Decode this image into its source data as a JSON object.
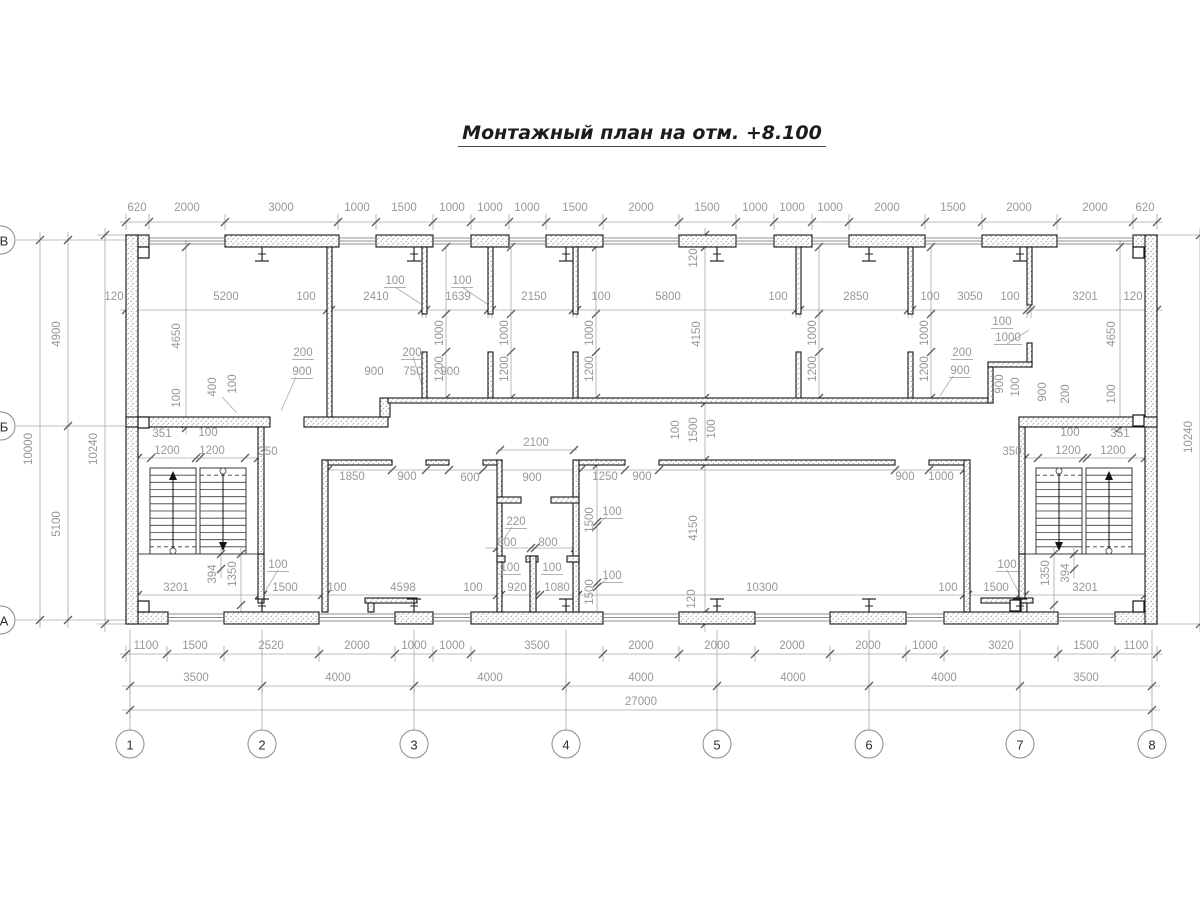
{
  "title": "Монтажный план на отм. +8.100",
  "drawing": {
    "type": "floor-plan",
    "total_width_mm": "27000",
    "axis_spans_mm": [
      "3500",
      "4000",
      "4000",
      "4000",
      "4000",
      "4000",
      "3500"
    ],
    "total_height_mm": "10000"
  },
  "axes": {
    "bottom": [
      {
        "label": "1",
        "x": 130
      },
      {
        "label": "2",
        "x": 262
      },
      {
        "label": "3",
        "x": 414
      },
      {
        "label": "4",
        "x": 566
      },
      {
        "label": "5",
        "x": 717
      },
      {
        "label": "6",
        "x": 869
      },
      {
        "label": "7",
        "x": 1020
      },
      {
        "label": "8",
        "x": 1152
      }
    ],
    "left": [
      {
        "label": "В",
        "y": 240
      },
      {
        "label": "Б",
        "y": 426
      },
      {
        "label": "А",
        "y": 620
      }
    ]
  },
  "labels": [
    {
      "t": "620",
      "x": 137,
      "y": 208
    },
    {
      "t": "2000",
      "x": 187,
      "y": 208
    },
    {
      "t": "3000",
      "x": 281,
      "y": 208
    },
    {
      "t": "1000",
      "x": 357,
      "y": 208
    },
    {
      "t": "1500",
      "x": 404,
      "y": 208
    },
    {
      "t": "1000",
      "x": 452,
      "y": 208
    },
    {
      "t": "1000",
      "x": 490,
      "y": 208
    },
    {
      "t": "1000",
      "x": 527,
      "y": 208
    },
    {
      "t": "1500",
      "x": 575,
      "y": 208
    },
    {
      "t": "2000",
      "x": 641,
      "y": 208
    },
    {
      "t": "1500",
      "x": 707,
      "y": 208
    },
    {
      "t": "1000",
      "x": 755,
      "y": 208
    },
    {
      "t": "1000",
      "x": 792,
      "y": 208
    },
    {
      "t": "1000",
      "x": 830,
      "y": 208
    },
    {
      "t": "2000",
      "x": 887,
      "y": 208
    },
    {
      "t": "1500",
      "x": 953,
      "y": 208
    },
    {
      "t": "2000",
      "x": 1019,
      "y": 208
    },
    {
      "t": "2000",
      "x": 1095,
      "y": 208
    },
    {
      "t": "620",
      "x": 1145,
      "y": 208
    },
    {
      "t": "120",
      "x": 114,
      "y": 297
    },
    {
      "t": "5200",
      "x": 226,
      "y": 297
    },
    {
      "t": "100",
      "x": 306,
      "y": 297
    },
    {
      "t": "2410",
      "x": 376,
      "y": 297
    },
    {
      "t": "1639",
      "x": 458,
      "y": 297
    },
    {
      "t": "2150",
      "x": 534,
      "y": 297
    },
    {
      "t": "100",
      "x": 601,
      "y": 297
    },
    {
      "t": "5800",
      "x": 668,
      "y": 297
    },
    {
      "t": "100",
      "x": 778,
      "y": 297
    },
    {
      "t": "2850",
      "x": 856,
      "y": 297
    },
    {
      "t": "100",
      "x": 930,
      "y": 297
    },
    {
      "t": "3050",
      "x": 970,
      "y": 297
    },
    {
      "t": "100",
      "x": 1010,
      "y": 297
    },
    {
      "t": "3201",
      "x": 1085,
      "y": 297
    },
    {
      "t": "120",
      "x": 1133,
      "y": 297
    },
    {
      "t": "100",
      "x": 395,
      "y": 281,
      "u": 1
    },
    {
      "t": "100",
      "x": 462,
      "y": 281,
      "u": 1
    },
    {
      "t": "1100",
      "x": 146,
      "y": 646
    },
    {
      "t": "1500",
      "x": 195,
      "y": 646
    },
    {
      "t": "2520",
      "x": 271,
      "y": 646
    },
    {
      "t": "2000",
      "x": 357,
      "y": 646
    },
    {
      "t": "1000",
      "x": 414,
      "y": 646
    },
    {
      "t": "1000",
      "x": 452,
      "y": 646
    },
    {
      "t": "3500",
      "x": 537,
      "y": 646
    },
    {
      "t": "2000",
      "x": 641,
      "y": 646
    },
    {
      "t": "2000",
      "x": 717,
      "y": 646
    },
    {
      "t": "2000",
      "x": 792,
      "y": 646
    },
    {
      "t": "2000",
      "x": 868,
      "y": 646
    },
    {
      "t": "1000",
      "x": 925,
      "y": 646
    },
    {
      "t": "3020",
      "x": 1001,
      "y": 646
    },
    {
      "t": "1500",
      "x": 1086,
      "y": 646
    },
    {
      "t": "1100",
      "x": 1136,
      "y": 646
    },
    {
      "t": "3500",
      "x": 196,
      "y": 678
    },
    {
      "t": "4000",
      "x": 338,
      "y": 678
    },
    {
      "t": "4000",
      "x": 490,
      "y": 678
    },
    {
      "t": "4000",
      "x": 641,
      "y": 678
    },
    {
      "t": "4000",
      "x": 793,
      "y": 678
    },
    {
      "t": "4000",
      "x": 944,
      "y": 678
    },
    {
      "t": "3500",
      "x": 1086,
      "y": 678
    },
    {
      "t": "27000",
      "x": 641,
      "y": 702
    },
    {
      "t": "4900",
      "x": 57,
      "y": 334,
      "r": 1
    },
    {
      "t": "5100",
      "x": 57,
      "y": 524,
      "r": 1
    },
    {
      "t": "10000",
      "x": 29,
      "y": 449,
      "r": 1
    },
    {
      "t": "10240",
      "x": 94,
      "y": 449,
      "r": 1
    },
    {
      "t": "10240",
      "x": 1189,
      "y": 437,
      "r": 1
    },
    {
      "t": "4650",
      "x": 177,
      "y": 336,
      "r": 1
    },
    {
      "t": "100",
      "x": 177,
      "y": 398,
      "r": 1
    },
    {
      "t": "4650",
      "x": 1112,
      "y": 334,
      "r": 1
    },
    {
      "t": "100",
      "x": 1112,
      "y": 394,
      "r": 1
    },
    {
      "t": "120",
      "x": 694,
      "y": 258,
      "r": 1
    },
    {
      "t": "4150",
      "x": 697,
      "y": 334,
      "r": 1
    },
    {
      "t": "100",
      "x": 676,
      "y": 430,
      "r": 1
    },
    {
      "t": "1500",
      "x": 694,
      "y": 430,
      "r": 1
    },
    {
      "t": "100",
      "x": 712,
      "y": 429,
      "r": 1
    },
    {
      "t": "4150",
      "x": 694,
      "y": 528,
      "r": 1
    },
    {
      "t": "120",
      "x": 692,
      "y": 599,
      "r": 1
    },
    {
      "t": "1000",
      "x": 440,
      "y": 333,
      "r": 1
    },
    {
      "t": "1200",
      "x": 440,
      "y": 369,
      "r": 1
    },
    {
      "t": "1000",
      "x": 505,
      "y": 333,
      "r": 1
    },
    {
      "t": "1200",
      "x": 505,
      "y": 369,
      "r": 1
    },
    {
      "t": "1000",
      "x": 590,
      "y": 333,
      "r": 1
    },
    {
      "t": "1200",
      "x": 590,
      "y": 369,
      "r": 1
    },
    {
      "t": "1000",
      "x": 813,
      "y": 333,
      "r": 1
    },
    {
      "t": "1200",
      "x": 813,
      "y": 369,
      "r": 1
    },
    {
      "t": "1000",
      "x": 925,
      "y": 333,
      "r": 1
    },
    {
      "t": "1200",
      "x": 925,
      "y": 369,
      "r": 1
    },
    {
      "t": "400",
      "x": 213,
      "y": 387,
      "r": 1
    },
    {
      "t": "100",
      "x": 233,
      "y": 384,
      "r": 1
    },
    {
      "t": "900",
      "x": 1000,
      "y": 384,
      "r": 1
    },
    {
      "t": "100",
      "x": 1016,
      "y": 387,
      "r": 1
    },
    {
      "t": "900",
      "x": 1043,
      "y": 392,
      "r": 1
    },
    {
      "t": "200",
      "x": 1066,
      "y": 394,
      "r": 1
    },
    {
      "t": "394",
      "x": 213,
      "y": 574,
      "r": 1
    },
    {
      "t": "1350",
      "x": 233,
      "y": 574,
      "r": 1
    },
    {
      "t": "1350",
      "x": 1046,
      "y": 573,
      "r": 1
    },
    {
      "t": "394",
      "x": 1066,
      "y": 573,
      "r": 1
    },
    {
      "t": "1500",
      "x": 590,
      "y": 520,
      "r": 1
    },
    {
      "t": "1500",
      "x": 590,
      "y": 592,
      "r": 1
    },
    {
      "t": "200",
      "x": 303,
      "y": 353,
      "u": 1
    },
    {
      "t": "900",
      "x": 302,
      "y": 372,
      "u": 1
    },
    {
      "t": "200",
      "x": 412,
      "y": 353,
      "u": 1
    },
    {
      "t": "900",
      "x": 374,
      "y": 372
    },
    {
      "t": "750",
      "x": 413,
      "y": 372
    },
    {
      "t": "900",
      "x": 450,
      "y": 372
    },
    {
      "t": "100",
      "x": 1002,
      "y": 322,
      "u": 1
    },
    {
      "t": "1000",
      "x": 1008,
      "y": 338,
      "u": 1
    },
    {
      "t": "200",
      "x": 962,
      "y": 353,
      "u": 1
    },
    {
      "t": "900",
      "x": 960,
      "y": 371,
      "u": 1
    },
    {
      "t": "351",
      "x": 162,
      "y": 434
    },
    {
      "t": "100",
      "x": 208,
      "y": 433
    },
    {
      "t": "1200",
      "x": 167,
      "y": 451
    },
    {
      "t": "1200",
      "x": 212,
      "y": 451
    },
    {
      "t": "350",
      "x": 268,
      "y": 452
    },
    {
      "t": "100",
      "x": 1070,
      "y": 433
    },
    {
      "t": "351",
      "x": 1120,
      "y": 434
    },
    {
      "t": "350",
      "x": 1012,
      "y": 452
    },
    {
      "t": "1200",
      "x": 1068,
      "y": 451
    },
    {
      "t": "1200",
      "x": 1113,
      "y": 451
    },
    {
      "t": "2100",
      "x": 536,
      "y": 443
    },
    {
      "t": "1850",
      "x": 352,
      "y": 477
    },
    {
      "t": "900",
      "x": 407,
      "y": 477
    },
    {
      "t": "600",
      "x": 470,
      "y": 478
    },
    {
      "t": "900",
      "x": 532,
      "y": 478
    },
    {
      "t": "1250",
      "x": 605,
      "y": 477
    },
    {
      "t": "900",
      "x": 642,
      "y": 477
    },
    {
      "t": "900",
      "x": 905,
      "y": 477
    },
    {
      "t": "1000",
      "x": 941,
      "y": 477
    },
    {
      "t": "220",
      "x": 516,
      "y": 522,
      "u": 1
    },
    {
      "t": "800",
      "x": 507,
      "y": 543
    },
    {
      "t": "800",
      "x": 548,
      "y": 543
    },
    {
      "t": "100",
      "x": 510,
      "y": 568,
      "u": 1
    },
    {
      "t": "100",
      "x": 552,
      "y": 568,
      "u": 1
    },
    {
      "t": "100",
      "x": 612,
      "y": 512,
      "u": 1
    },
    {
      "t": "100",
      "x": 612,
      "y": 576,
      "u": 1
    },
    {
      "t": "3201",
      "x": 176,
      "y": 588
    },
    {
      "t": "1500",
      "x": 285,
      "y": 588
    },
    {
      "t": "100",
      "x": 337,
      "y": 588
    },
    {
      "t": "4598",
      "x": 403,
      "y": 588
    },
    {
      "t": "100",
      "x": 473,
      "y": 588
    },
    {
      "t": "920",
      "x": 517,
      "y": 588
    },
    {
      "t": "1080",
      "x": 557,
      "y": 588
    },
    {
      "t": "100",
      "x": 278,
      "y": 565,
      "u": 1
    },
    {
      "t": "10300",
      "x": 762,
      "y": 588
    },
    {
      "t": "100",
      "x": 948,
      "y": 588
    },
    {
      "t": "1500",
      "x": 996,
      "y": 588
    },
    {
      "t": "3201",
      "x": 1085,
      "y": 588
    },
    {
      "t": "100",
      "x": 1007,
      "y": 565,
      "u": 1
    }
  ]
}
